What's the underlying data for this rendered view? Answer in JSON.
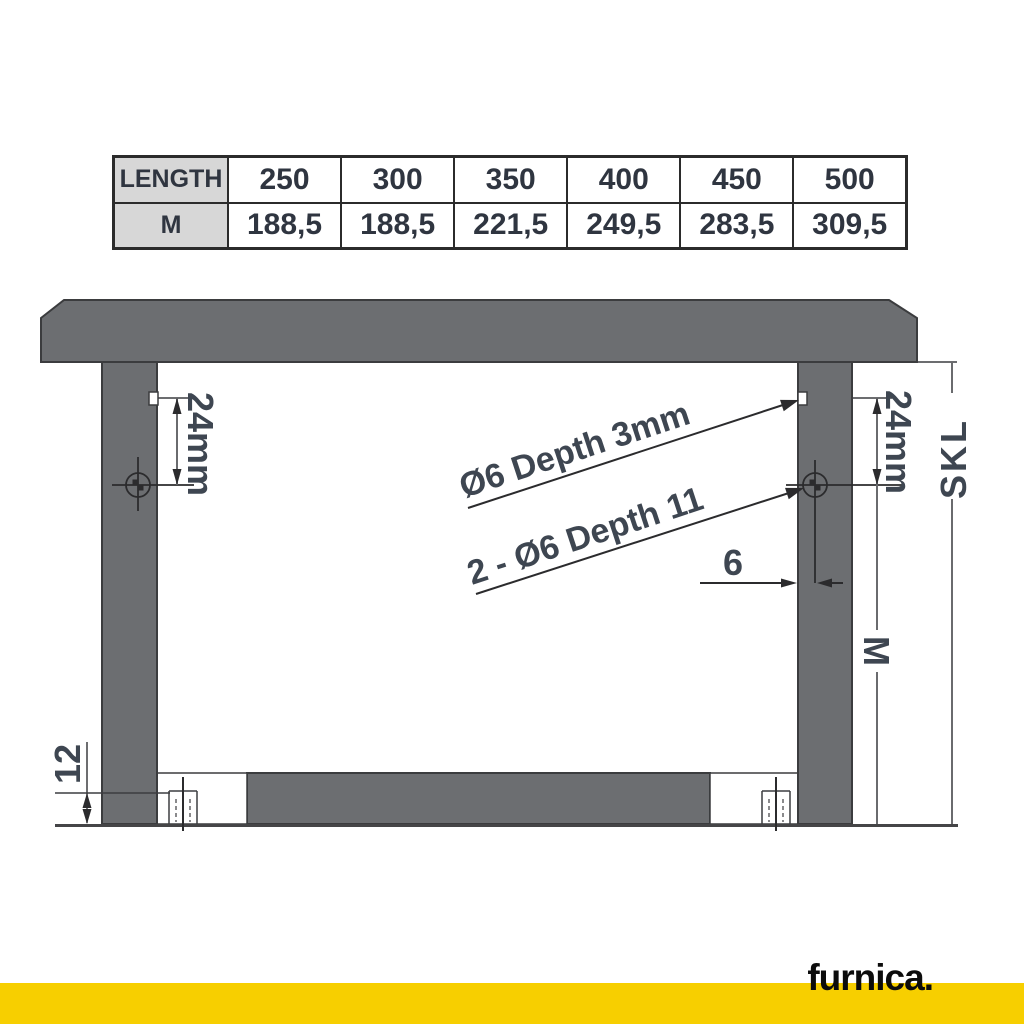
{
  "table": {
    "header_row": [
      "LENGTH",
      "250",
      "300",
      "350",
      "400",
      "450",
      "500"
    ],
    "value_row": [
      "M",
      "188,5",
      "188,5",
      "221,5",
      "249,5",
      "283,5",
      "309,5"
    ]
  },
  "drawing": {
    "dim_left_offset": "24mm",
    "dim_right_offset": "24mm",
    "callout_top_hole": "Ø6 Depth 3mm",
    "callout_side_holes": "2 - Ø6 Depth 11",
    "dim_edge_distance": "6",
    "dim_bottom_recess": "12",
    "label_skl": "SKL",
    "label_m": "M"
  },
  "footer": {
    "brand": "furnica."
  },
  "colors": {
    "accent_yellow": "#F7CF00",
    "panel_gray": "#6C6E71",
    "outline": "#3b3c3e",
    "dim_text": "#3e4651"
  }
}
